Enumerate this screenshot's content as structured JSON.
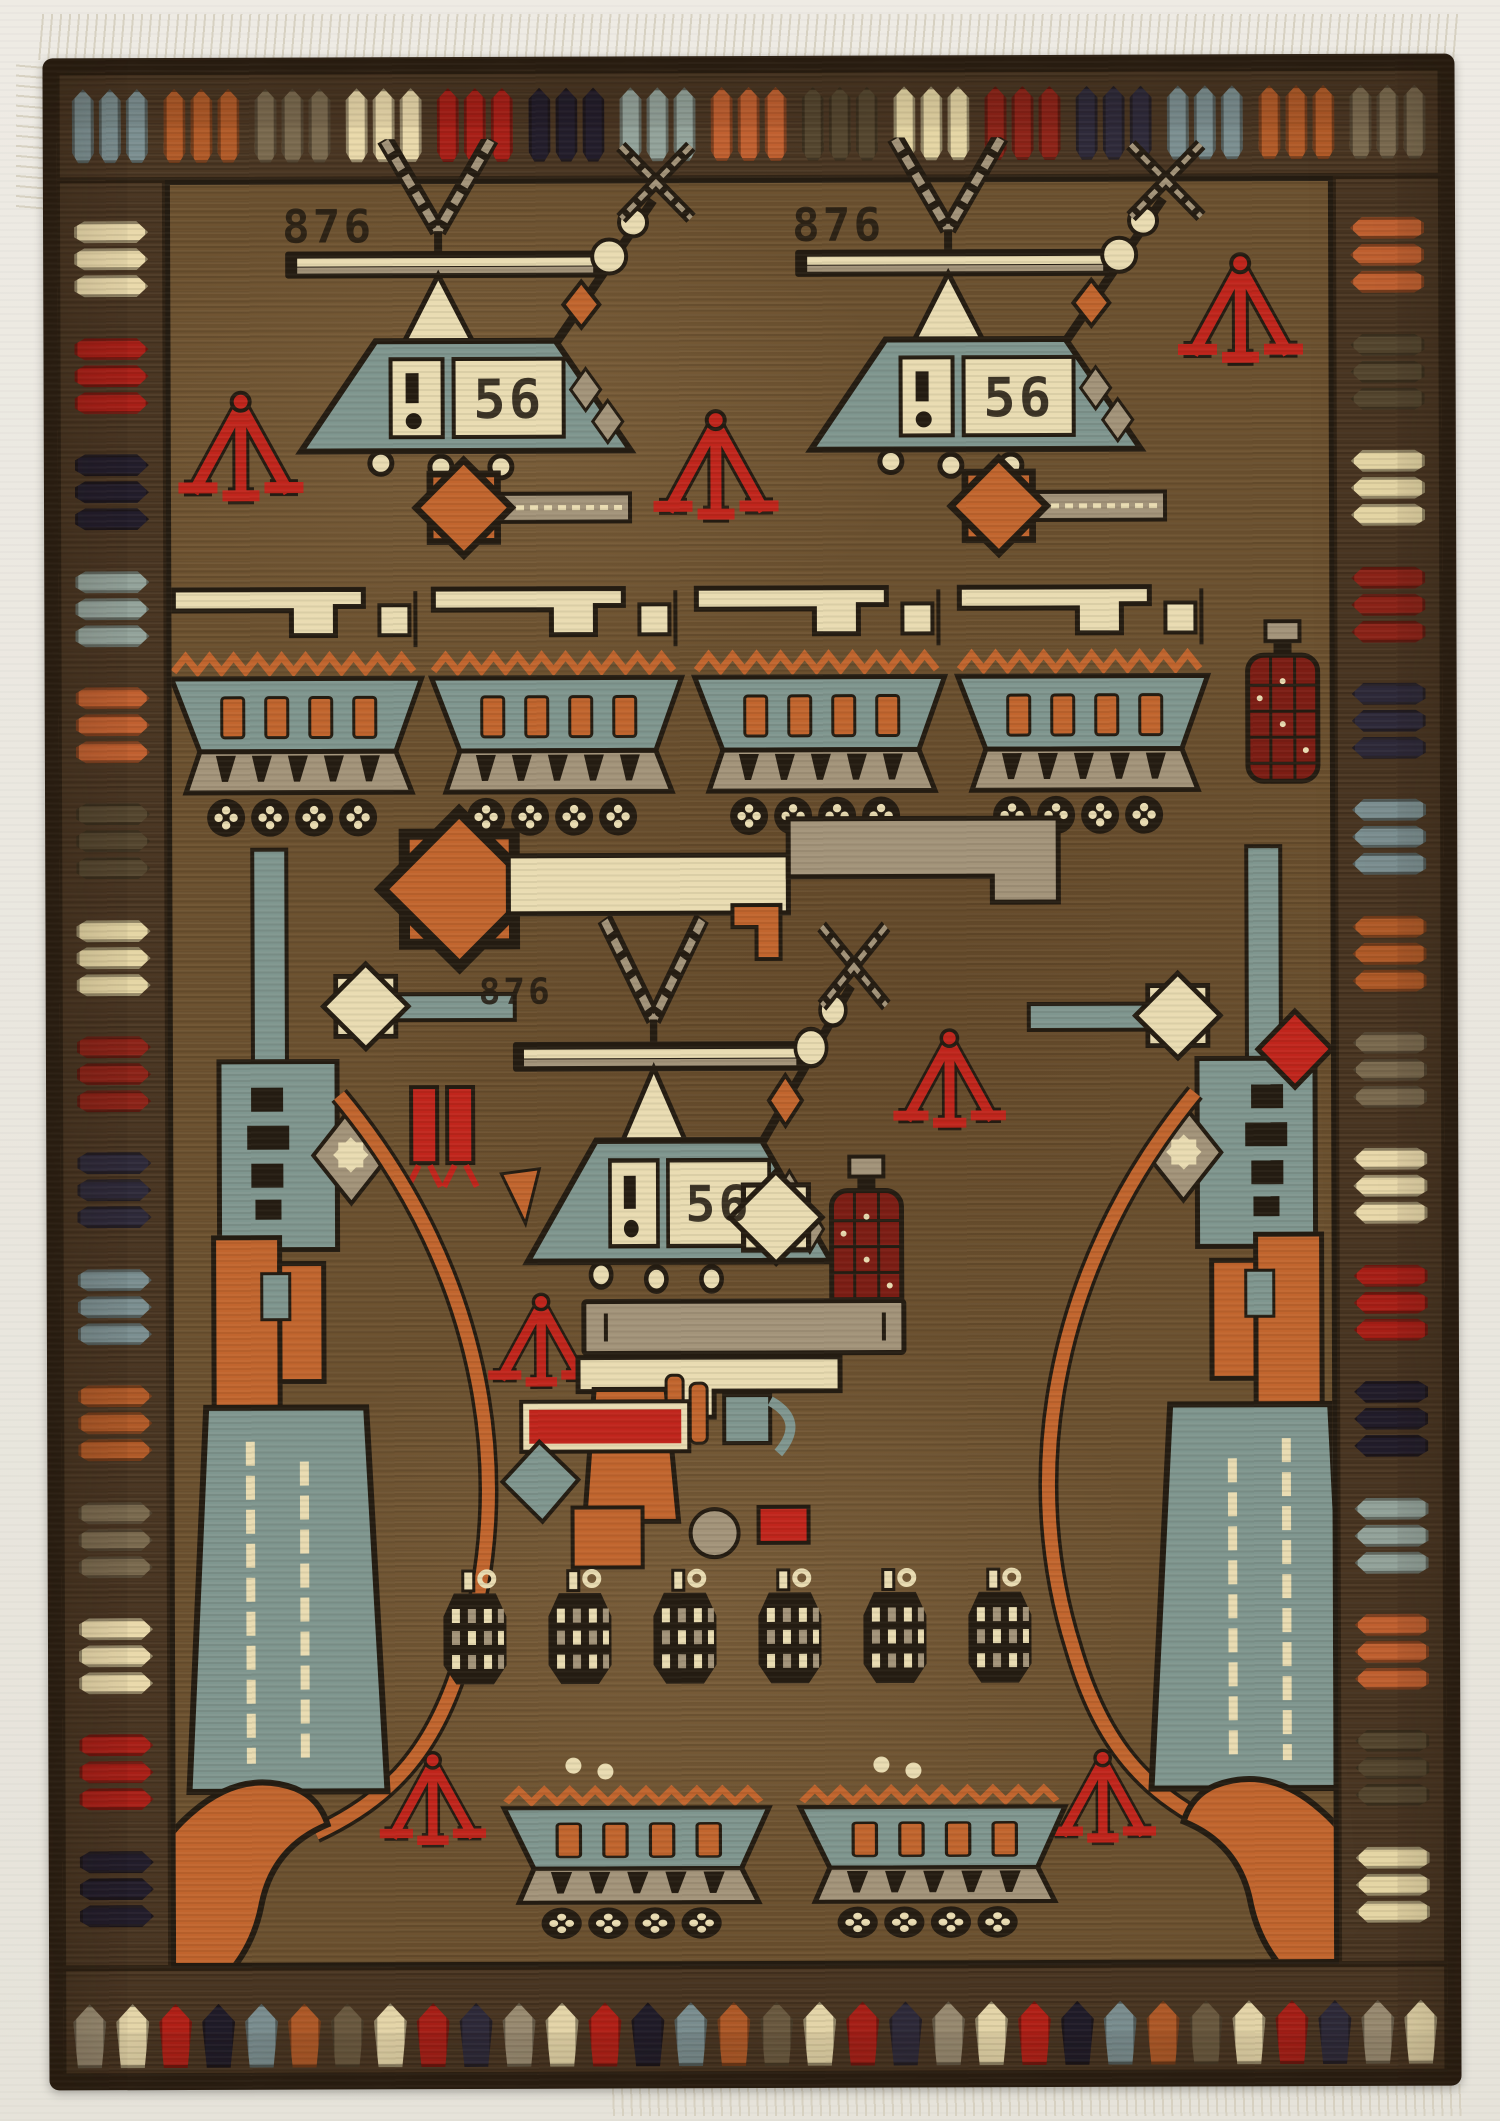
{
  "image": {
    "kind": "photograph",
    "subject": "Afghan war rug woven with helicopters, armored vehicles, rifles, a pistol and grenades",
    "backdrop": "off-white textured surface with white fringe at top and bottom edges"
  },
  "inscriptions": {
    "serial_number": "876",
    "serial_occurrences": 3,
    "panel_number": "56",
    "panel_occurrences": 3
  },
  "palette": {
    "paper": "#ebe8e0",
    "rug_edge": "#2e2114",
    "border_brown": "#4b3723",
    "field": "#6d5230",
    "outline": "#241c12",
    "steel": "#7f968f",
    "cream": "#e9dcb2",
    "taupe": "#a3947a",
    "orange": "#c1652e",
    "red": "#c0251c",
    "deep_red": "#7c1d14",
    "navy": "#262231",
    "fringe": "#d6d0c0"
  },
  "border": {
    "bullets_per_group": 3,
    "top_groups": 15,
    "side_groups": 15,
    "bottom_tulips": 32,
    "bullet_colors": [
      "#7b8f91",
      "#b05a28",
      "#7a6a4f",
      "#e9d9ab",
      "#a81f17",
      "#221d2b",
      "#93a39b",
      "#c06030",
      "#54462f",
      "#e5d6a5",
      "#8c2318",
      "#2e2a3a"
    ],
    "bottom_tulip_colors": [
      "#9a8c72",
      "#e7d8ab",
      "#b32017",
      "#201c29",
      "#7b8f91",
      "#b05a28",
      "#6b5a40",
      "#e7d8ab",
      "#a81f17",
      "#2e2a3a"
    ]
  },
  "motifs": {
    "helicopters": 3,
    "armored_vehicles_top_row": 4,
    "armored_vehicles_bottom_row": 2,
    "vertical_rifles": 2,
    "horizontal_rifle": 1,
    "pistol": 1,
    "pineapple_grenades": 6,
    "bottle_grenades": 2,
    "red_tripod_emblems": 7,
    "rocket_motifs": 4,
    "red_diamond": 1,
    "corner_leaves": 2
  }
}
